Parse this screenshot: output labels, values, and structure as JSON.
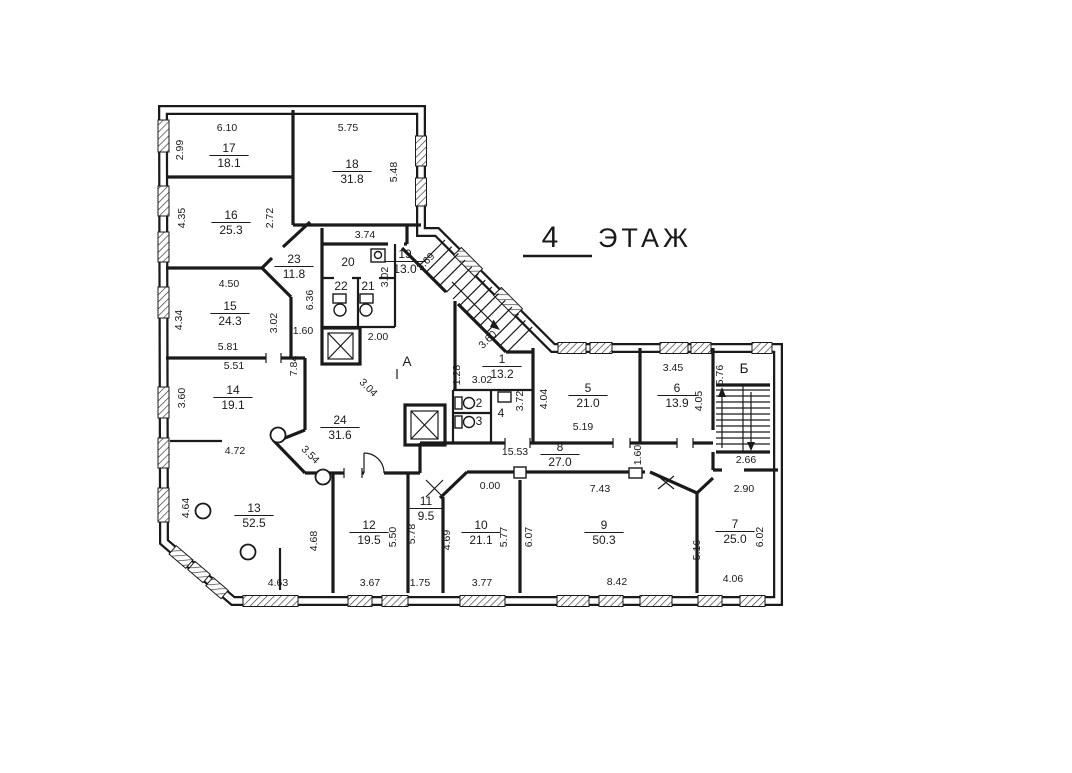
{
  "title": {
    "number": "4",
    "word": "ЭТАЖ"
  },
  "colors": {
    "ink": "#1a1a1a",
    "paper": "#ffffff"
  },
  "stairwells": [
    {
      "label": "А",
      "x": 407,
      "y": 366
    },
    {
      "label": "Б",
      "x": 744,
      "y": 373
    }
  ],
  "rooms": [
    {
      "num": "17",
      "area": "18.1",
      "x": 229,
      "y": 152
    },
    {
      "num": "16",
      "area": "25.3",
      "x": 231,
      "y": 219
    },
    {
      "num": "18",
      "area": "31.8",
      "x": 352,
      "y": 168
    },
    {
      "num": "15",
      "area": "24.3",
      "x": 230,
      "y": 310
    },
    {
      "num": "14",
      "area": "19.1",
      "x": 233,
      "y": 394
    },
    {
      "num": "23",
      "area": "11.8",
      "x": 294,
      "y": 263
    },
    {
      "num": "19",
      "area": "13.0",
      "x": 405,
      "y": 258
    },
    {
      "num": "20",
      "x": 348,
      "y": 266
    },
    {
      "num": "22",
      "x": 341,
      "y": 290
    },
    {
      "num": "21",
      "x": 368,
      "y": 290
    },
    {
      "num": "24",
      "area": "31.6",
      "x": 340,
      "y": 424
    },
    {
      "num": "1",
      "area": "13.2",
      "x": 502,
      "y": 363
    },
    {
      "num": "2",
      "x": 479,
      "y": 407
    },
    {
      "num": "3",
      "x": 479,
      "y": 425
    },
    {
      "num": "4",
      "x": 501,
      "y": 417
    },
    {
      "num": "5",
      "area": "21.0",
      "x": 588,
      "y": 392
    },
    {
      "num": "6",
      "area": "13.9",
      "x": 677,
      "y": 392
    },
    {
      "num": "7",
      "area": "25.0",
      "x": 735,
      "y": 528
    },
    {
      "num": "8",
      "area": "27.0",
      "x": 560,
      "y": 451
    },
    {
      "num": "9",
      "area": "50.3",
      "x": 604,
      "y": 529
    },
    {
      "num": "10",
      "area": "21.1",
      "x": 481,
      "y": 529
    },
    {
      "num": "11",
      "area": "9.5",
      "x": 426,
      "y": 505
    },
    {
      "num": "12",
      "area": "19.5",
      "x": 369,
      "y": 529
    },
    {
      "num": "13",
      "area": "52.5",
      "x": 254,
      "y": 512
    }
  ],
  "dimensions": [
    {
      "t": "6.10",
      "x": 227,
      "y": 131
    },
    {
      "t": "2.99",
      "x": 183,
      "y": 150,
      "r": -90
    },
    {
      "t": "5.75",
      "x": 348,
      "y": 131
    },
    {
      "t": "5.48",
      "x": 397,
      "y": 172,
      "r": -90
    },
    {
      "t": "4.35",
      "x": 185,
      "y": 218,
      "r": -90
    },
    {
      "t": "2.72",
      "x": 273,
      "y": 218,
      "r": -90
    },
    {
      "t": "4.50",
      "x": 229,
      "y": 287
    },
    {
      "t": "4.34",
      "x": 182,
      "y": 320,
      "r": -90
    },
    {
      "t": "3.02",
      "x": 277,
      "y": 323,
      "r": -90
    },
    {
      "t": "5.81",
      "x": 228,
      "y": 350
    },
    {
      "t": "5.51",
      "x": 234,
      "y": 369
    },
    {
      "t": "7.84",
      "x": 297,
      "y": 366,
      "r": -90
    },
    {
      "t": "3.60",
      "x": 185,
      "y": 398,
      "r": -90
    },
    {
      "t": "4.72",
      "x": 235,
      "y": 454
    },
    {
      "t": "3.74",
      "x": 365,
      "y": 238
    },
    {
      "t": "3.02",
      "x": 388,
      "y": 277,
      "r": -90
    },
    {
      "t": "6.36",
      "x": 313,
      "y": 300,
      "r": -90
    },
    {
      "t": "1.60",
      "x": 303,
      "y": 334
    },
    {
      "t": "2.00",
      "x": 378,
      "y": 340
    },
    {
      "t": "3.69",
      "x": 428,
      "y": 264,
      "r": -45
    },
    {
      "t": "3.60",
      "x": 490,
      "y": 342,
      "r": -45
    },
    {
      "t": "3.04",
      "x": 366,
      "y": 390,
      "r": 45
    },
    {
      "t": "3.54",
      "x": 308,
      "y": 457,
      "r": 45
    },
    {
      "t": "1.28",
      "x": 460,
      "y": 375,
      "r": -90
    },
    {
      "t": "3.02",
      "x": 482,
      "y": 383
    },
    {
      "t": "3.72",
      "x": 523,
      "y": 401,
      "r": -90
    },
    {
      "t": "4.04",
      "x": 547,
      "y": 399,
      "r": -90
    },
    {
      "t": "5.19",
      "x": 583,
      "y": 430
    },
    {
      "t": "3.45",
      "x": 673,
      "y": 371
    },
    {
      "t": "4.05",
      "x": 702,
      "y": 401,
      "r": -90
    },
    {
      "t": "5.76",
      "x": 723,
      "y": 375,
      "r": -90
    },
    {
      "t": "1.60",
      "x": 641,
      "y": 455,
      "r": -90
    },
    {
      "t": "15.53",
      "x": 515,
      "y": 455
    },
    {
      "t": "2.66",
      "x": 746,
      "y": 463
    },
    {
      "t": "2.90",
      "x": 744,
      "y": 492
    },
    {
      "t": "0.00",
      "x": 490,
      "y": 489
    },
    {
      "t": "7.43",
      "x": 600,
      "y": 492
    },
    {
      "t": "4.64",
      "x": 189,
      "y": 508,
      "r": -90
    },
    {
      "t": "4.68",
      "x": 317,
      "y": 541,
      "r": -90
    },
    {
      "t": "5.50",
      "x": 396,
      "y": 537,
      "r": -90
    },
    {
      "t": "5.78",
      "x": 415,
      "y": 534,
      "r": -90
    },
    {
      "t": "4.69",
      "x": 450,
      "y": 540,
      "r": -90
    },
    {
      "t": "5.77",
      "x": 507,
      "y": 537,
      "r": -90
    },
    {
      "t": "6.07",
      "x": 532,
      "y": 537,
      "r": -90
    },
    {
      "t": "5.16",
      "x": 700,
      "y": 550,
      "r": -90
    },
    {
      "t": "6.02",
      "x": 763,
      "y": 537,
      "r": -90
    },
    {
      "t": "4.63",
      "x": 278,
      "y": 586
    },
    {
      "t": "3.67",
      "x": 370,
      "y": 586
    },
    {
      "t": "1.75",
      "x": 420,
      "y": 586
    },
    {
      "t": "3.77",
      "x": 482,
      "y": 586
    },
    {
      "t": "8.42",
      "x": 617,
      "y": 585
    },
    {
      "t": "4.06",
      "x": 733,
      "y": 582
    }
  ]
}
